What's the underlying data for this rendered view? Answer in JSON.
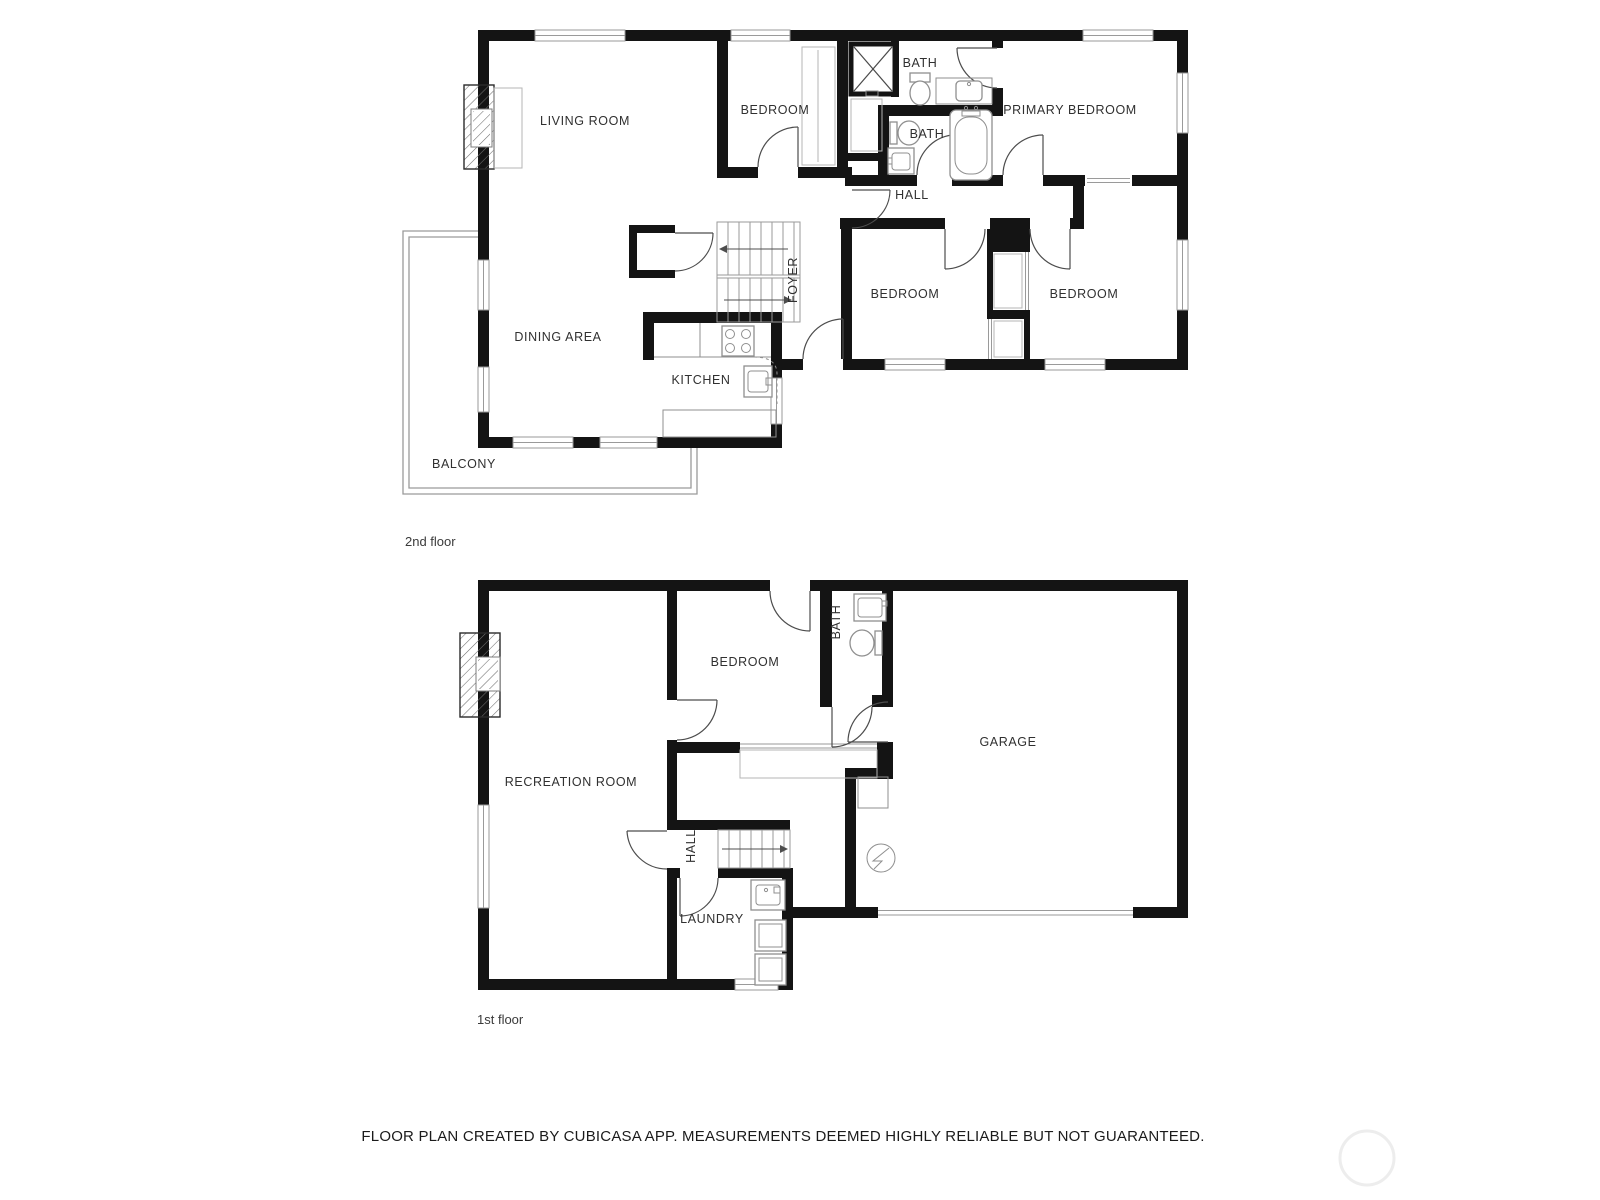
{
  "document": {
    "footer": "FLOOR PLAN CREATED BY CUBICASA APP. MEASUREMENTS DEEMED HIGHLY RELIABLE BUT NOT GUARANTEED."
  },
  "colors": {
    "wall": "#141414",
    "door": "#4d4d4d",
    "fixture": "#8f8f8f",
    "window": "#9a9a9a",
    "label": "#303030",
    "watermark": "#ededed"
  },
  "floors": [
    {
      "name": "2nd floor",
      "rooms": [
        {
          "id": "living-room",
          "label": "LIVING ROOM"
        },
        {
          "id": "bedroom-top",
          "label": "BEDROOM"
        },
        {
          "id": "bath-upper",
          "label": "BATH"
        },
        {
          "id": "primary-bedroom",
          "label": "PRIMARY BEDROOM"
        },
        {
          "id": "bath-lower",
          "label": "BATH"
        },
        {
          "id": "hall",
          "label": "HALL"
        },
        {
          "id": "foyer",
          "label": "FOYER"
        },
        {
          "id": "bedroom-mid",
          "label": "BEDROOM"
        },
        {
          "id": "bedroom-right",
          "label": "BEDROOM"
        },
        {
          "id": "dining-area",
          "label": "DINING AREA"
        },
        {
          "id": "kitchen",
          "label": "KITCHEN"
        },
        {
          "id": "balcony",
          "label": "BALCONY"
        }
      ]
    },
    {
      "name": "1st floor",
      "rooms": [
        {
          "id": "bedroom",
          "label": "BEDROOM"
        },
        {
          "id": "bath",
          "label": "BATH"
        },
        {
          "id": "garage",
          "label": "GARAGE"
        },
        {
          "id": "recreation-room",
          "label": "RECREATION ROOM"
        },
        {
          "id": "hall",
          "label": "HALL"
        },
        {
          "id": "laundry",
          "label": "LAUNDRY"
        }
      ]
    }
  ]
}
